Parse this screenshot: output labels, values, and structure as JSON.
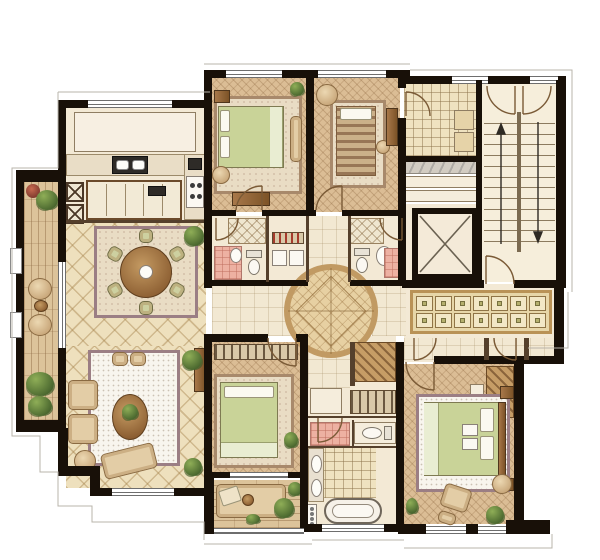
{
  "meta": {
    "type": "apartment-floor-plan",
    "style": "hand-rendered watercolor rendering, no text labels",
    "canvas": {
      "width": 600,
      "height": 560
    }
  },
  "palette": {
    "background": "#ffffff",
    "outline": "#b9b4ab",
    "wall": "#181008",
    "wood_floor": "#dbbd95",
    "pale_floor": "#f3e9d5",
    "tile_cream": "#eee0bd",
    "plank": "#dcc39a",
    "grid_tile": "#efe2c0",
    "pink_tile": "#edb1a2",
    "rug_white": "#f8f5ee",
    "rug_border": "#9b7e84",
    "bedding_green": "#c9d398",
    "bedding_fold": "#e9edd2",
    "wood_dark": "#8a5c30",
    "plant_dark": "#49662e",
    "marble": "#d2ccc2",
    "medallion": "#e7d0a2",
    "medallion_ring": "#c19a63",
    "closet_frame": "#b99256",
    "closet_cell": "#f2e7c6",
    "closet_inner": "#b5b06e",
    "stair_floor": "#f6eedb",
    "door_arc": "#7a5a36"
  },
  "fixtures": {
    "dining_chairs": 6,
    "stove_burners": 4,
    "kitchen_sink_basins": 2,
    "kitchen_island_panels": 4,
    "vanity_sinks": 2,
    "towel_hooks": 4,
    "utility_washers": 2,
    "stair_flights": 2,
    "stair_treads_per_flight": 12,
    "closet_rows": 2,
    "closet_columns": 7,
    "balcony_window_pilasters": 2
  },
  "rooms": [
    {
      "id": "west-balcony",
      "features": [
        "plank floor",
        "planters",
        "two lounge chairs",
        "side table"
      ]
    },
    {
      "id": "kitchen",
      "features": [
        "bay counter",
        "double sink",
        "island",
        "four-burner stove",
        "x-front cabinets"
      ]
    },
    {
      "id": "dining-room",
      "features": [
        "diamond tile",
        "round table",
        "six chairs",
        "area rug",
        "potted plant"
      ]
    },
    {
      "id": "living-room",
      "features": [
        "white speckled rug",
        "sofa seats",
        "oval coffee table",
        "chaise",
        "tall cabinet",
        "plants"
      ]
    },
    {
      "id": "bedroom-1",
      "features": [
        "herringbone floor",
        "double bed",
        "bench",
        "dresser",
        "nightstand"
      ]
    },
    {
      "id": "bedroom-2",
      "features": [
        "herringbone floor",
        "striped single bed",
        "round chair",
        "stool",
        "cabinet"
      ]
    },
    {
      "id": "bathroom-2",
      "features": [
        "shower",
        "toilet",
        "pink tile"
      ]
    },
    {
      "id": "utility-closet",
      "features": [
        "shelf with bottles",
        "two washers"
      ]
    },
    {
      "id": "bathroom-3",
      "features": [
        "shower",
        "toilet",
        "basin",
        "pink tile"
      ]
    },
    {
      "id": "multi-room",
      "features": [
        "square grid mat floor",
        "cabinets"
      ]
    },
    {
      "id": "entry-steps",
      "features": [
        "marble counter",
        "two steps"
      ]
    },
    {
      "id": "elevator",
      "features": [
        "shaft with X"
      ]
    },
    {
      "id": "staircase",
      "features": [
        "two flights",
        "center stringer",
        "up and down arrows",
        "three doors"
      ]
    },
    {
      "id": "circular-foyer",
      "features": [
        "round medallion floor",
        "diamond inlay"
      ]
    },
    {
      "id": "closet-corridor",
      "features": [
        "built-in wardrobe 7x2 doors",
        "two door swings"
      ]
    },
    {
      "id": "master-bedroom",
      "features": [
        "herringbone floor",
        "double bed",
        "wardrobe",
        "armchair",
        "ottoman",
        "plants"
      ]
    },
    {
      "id": "dressing-area",
      "features": [
        "wardrobes",
        "hanging rail"
      ]
    },
    {
      "id": "master-bathroom",
      "features": [
        "pink shower",
        "toilet nook",
        "double vanity",
        "towel hooks",
        "bathtub"
      ]
    },
    {
      "id": "bedroom-4",
      "features": [
        "herringbone floor",
        "double bed",
        "wardrobe rail",
        "plant"
      ]
    },
    {
      "id": "south-balcony",
      "features": [
        "daybed",
        "cushion",
        "tray",
        "plants"
      ]
    }
  ]
}
